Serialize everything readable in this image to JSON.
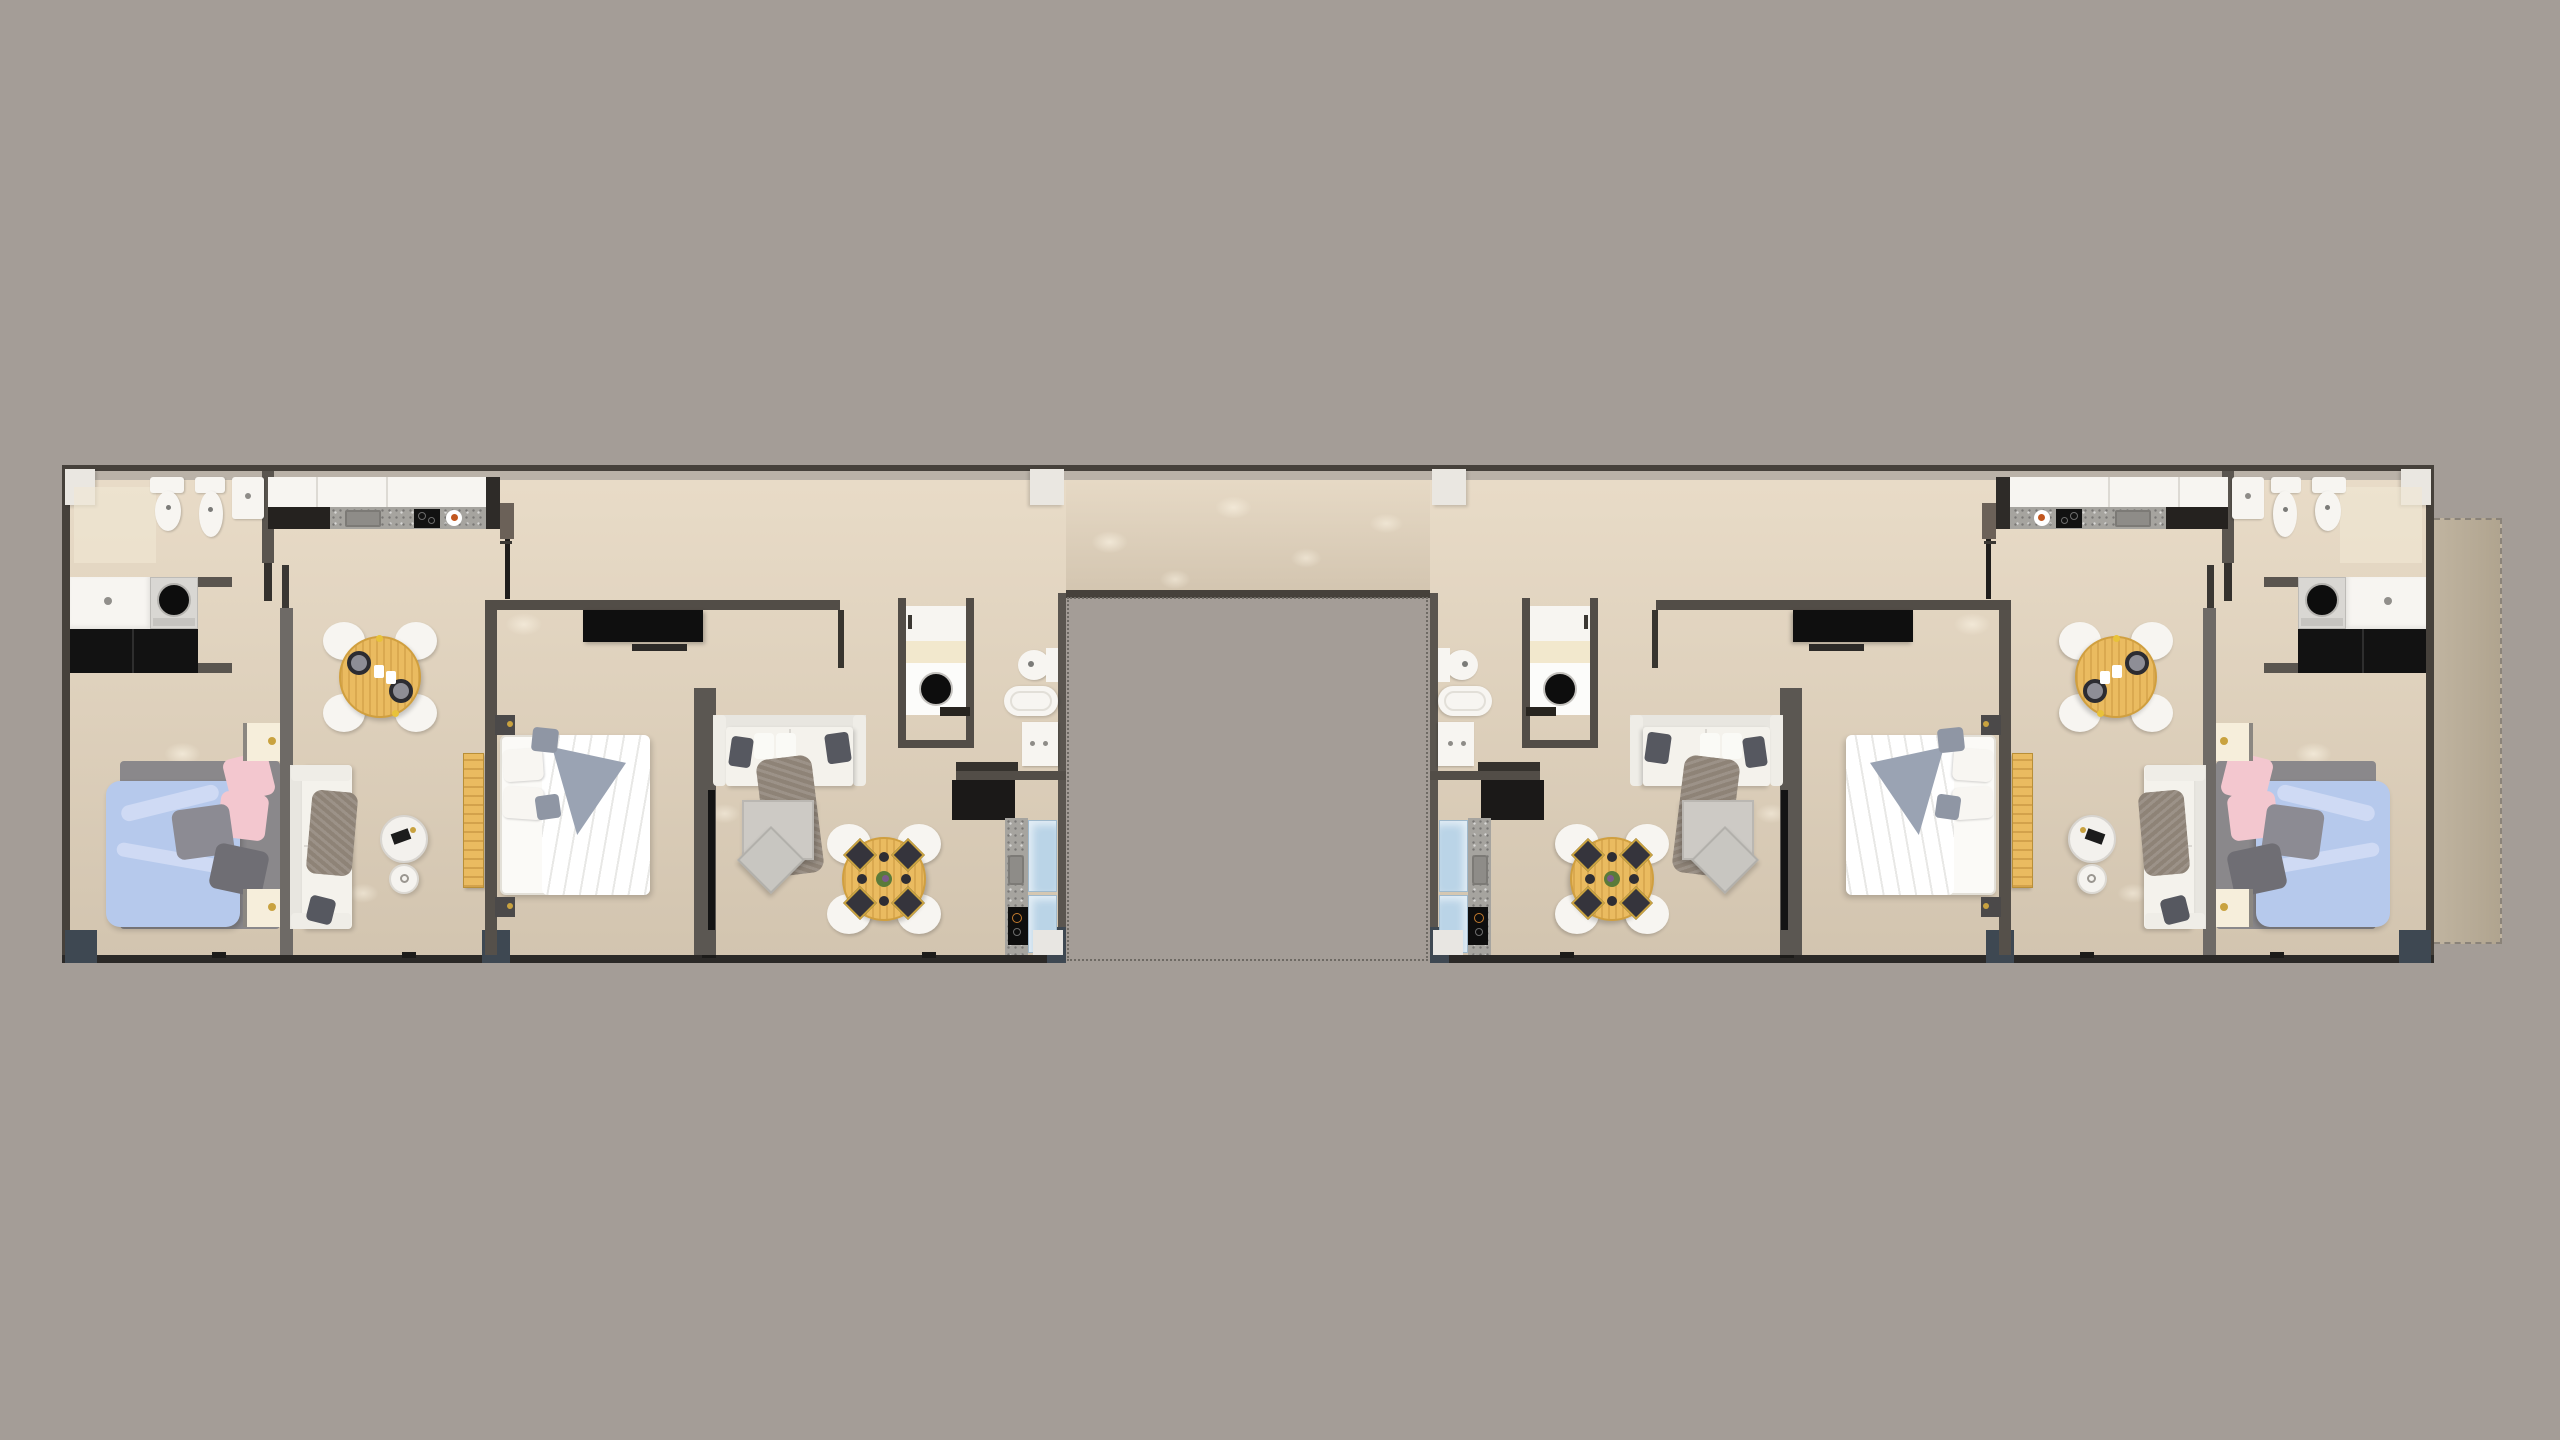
{
  "scene": {
    "type": "architectural-floor-plan",
    "view": "top-down 3d render",
    "description": "Residential floor with two mirrored wings joined by a top corridor, open courtyard cutout at bottom center, terrace strip at far right",
    "corridor": {
      "position": "top, spanning both wings",
      "columns": 4
    },
    "courtyard_cutout": {
      "position": "bottom center",
      "border": "dotted"
    },
    "terrace": {
      "position": "far right of right wing",
      "border": "dashed"
    },
    "units": [
      {
        "id": "apartment-1",
        "wing": "left outer",
        "rooms": [
          "bathroom",
          "laundry-nook",
          "kitchen",
          "dining-area",
          "bedroom",
          "living-area"
        ],
        "furniture": [
          "toilet",
          "bidet",
          "bathroom-sink",
          "shower-mat",
          "laundry-counter",
          "washing-machine",
          "black-cabinets",
          "kitchen-counter",
          "kitchen-sink",
          "cooktop",
          "breakfast-plate",
          "tall-cabinet",
          "round-dining-table",
          "4 dining-chairs",
          "2 place-settings",
          "double-bed blue+pink bedding",
          "2 nightstands with lamps",
          "white-sofa",
          "2 round side-tables",
          "wood-bench"
        ]
      },
      {
        "id": "apartment-2",
        "wing": "left inner",
        "rooms": [
          "bedroom",
          "living-area",
          "dining-area",
          "laundry-closet",
          "bathroom",
          "kitchen-strip"
        ],
        "furniture": [
          "tv-console",
          "double-bed white+gray bedding",
          "2 corner-cubes",
          "partition-wall with tv-panel",
          "white-sofa",
          "coffee-table",
          "ottoman",
          "round-dining-table",
          "4 dining-chairs",
          "4 dark-placemats",
          "center-plant",
          "washing-machine-closet",
          "toilet",
          "bathtub",
          "bathroom-cabinet",
          "kitchen-counter-strip",
          "cooktop",
          "glass-cabinets"
        ]
      },
      {
        "id": "apartment-3",
        "wing": "right inner",
        "mirror_of": "apartment-2"
      },
      {
        "id": "apartment-4",
        "wing": "right outer",
        "mirror_of": "apartment-1"
      }
    ]
  },
  "palette": {
    "bg": "#a49d97",
    "floor-light": "#e9dcc8",
    "floor-dark": "#d2c4af",
    "wall-dark": "#46413b",
    "wall-mid": "#5a554f",
    "wall-heavy": "#2b2927",
    "wall-face": "#bab2a8",
    "wall-brown": "#6b6158",
    "wall-soft": "#6e6a66",
    "accent-steel": "#3e4852",
    "col-white": "#eae7e1",
    "white-furn": "#f7f5f1",
    "cream": "#f2e8cd",
    "night-cream": "#f6eedb",
    "black-furn": "#121212",
    "washer-body": "#d9d7d3",
    "wood": "#eabb60",
    "wood-dark": "#d09f3f",
    "granite": "#a6a49f",
    "sink-gray": "#8e8c88",
    "glass-blue": "#bad4e7",
    "duvet-blue": "#b6c9ec",
    "duvet-fold": "#cfdaf4",
    "pink": "#f3c7cf",
    "pillow-gray": "#8c8b93",
    "throw-dark": "#6f6e74",
    "bed-frame": "#8a888b",
    "bed2-accent": "#9aa3b3",
    "pillow-blue-gray": "#8f96a4",
    "sofa-white": "#f4f2ec",
    "sofa-back": "#e8e6e0",
    "throw-taupe": "#8e8377",
    "dark-pillow": "#565860",
    "table-gray": "#cdcac5",
    "ottoman-gray": "#c8c6c1",
    "terrace": "#c0b4a0",
    "terrace-dark": "#b0a48f",
    "gold": "#c9a23f",
    "mat-dark": "#35343c",
    "plant-green": "#5a7a3a",
    "plant-purple": "#7a5a8a",
    "door-black": "#1f1d1b",
    "dot-border": "#6e6a64"
  }
}
